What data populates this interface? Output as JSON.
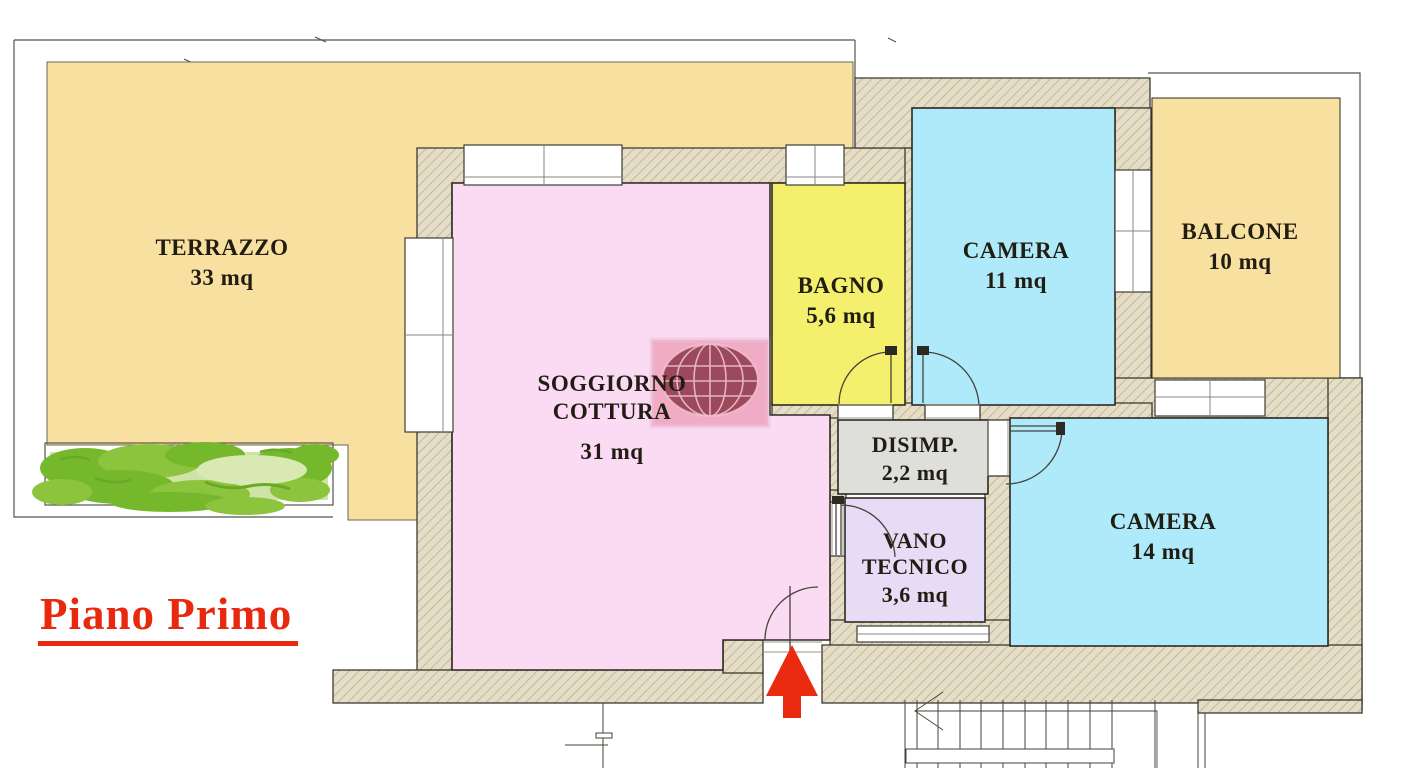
{
  "title": "Piano Primo",
  "rooms": [
    {
      "id": "terrazzo",
      "name": "TERRAZZO",
      "area": "33 mq",
      "color": "#f8e1a0"
    },
    {
      "id": "soggiorno-cottura",
      "name": "SOGGIORNO COTTURA",
      "area": "31 mq",
      "color": "#fbdbf3"
    },
    {
      "id": "bagno",
      "name": "BAGNO",
      "area": "5,6 mq",
      "color": "#f4ef6d"
    },
    {
      "id": "camera-11",
      "name": "CAMERA",
      "area": "11 mq",
      "color": "#aeeafa"
    },
    {
      "id": "balcone",
      "name": "BALCONE",
      "area": "10 mq",
      "color": "#f8e1a0"
    },
    {
      "id": "disimpegno",
      "name": "DISIMP.",
      "area": "2,2 mq",
      "color": "#dededa"
    },
    {
      "id": "vano-tecnico",
      "name": "VANO TECNICO",
      "area": "3,6 mq",
      "color": "#e7dcf5"
    },
    {
      "id": "camera-14",
      "name": "CAMERA",
      "area": "14 mq",
      "color": "#aeeafa"
    }
  ],
  "colors": {
    "wall_fill": "#e6ddc7",
    "wall_hatch_line": "#b8af96",
    "accent_red": "#ea2b10",
    "planter_bg": "#cfe3a6",
    "hedge_dark": "#76b82c",
    "hedge_mid": "#8cc43d",
    "hedge_light": "#d9e9b4",
    "watermark_square": "#e0607c",
    "watermark_globe": "#7c2336",
    "line": "#45433a",
    "text": "#211d12"
  },
  "symbols": {
    "entrance_arrow": "red-up-arrow",
    "watermark": "globe-logo-watermark",
    "hedge": "hedge-plants",
    "stairs": "staircase",
    "doors": "door-swing-arcs",
    "windows": "window-frames"
  }
}
